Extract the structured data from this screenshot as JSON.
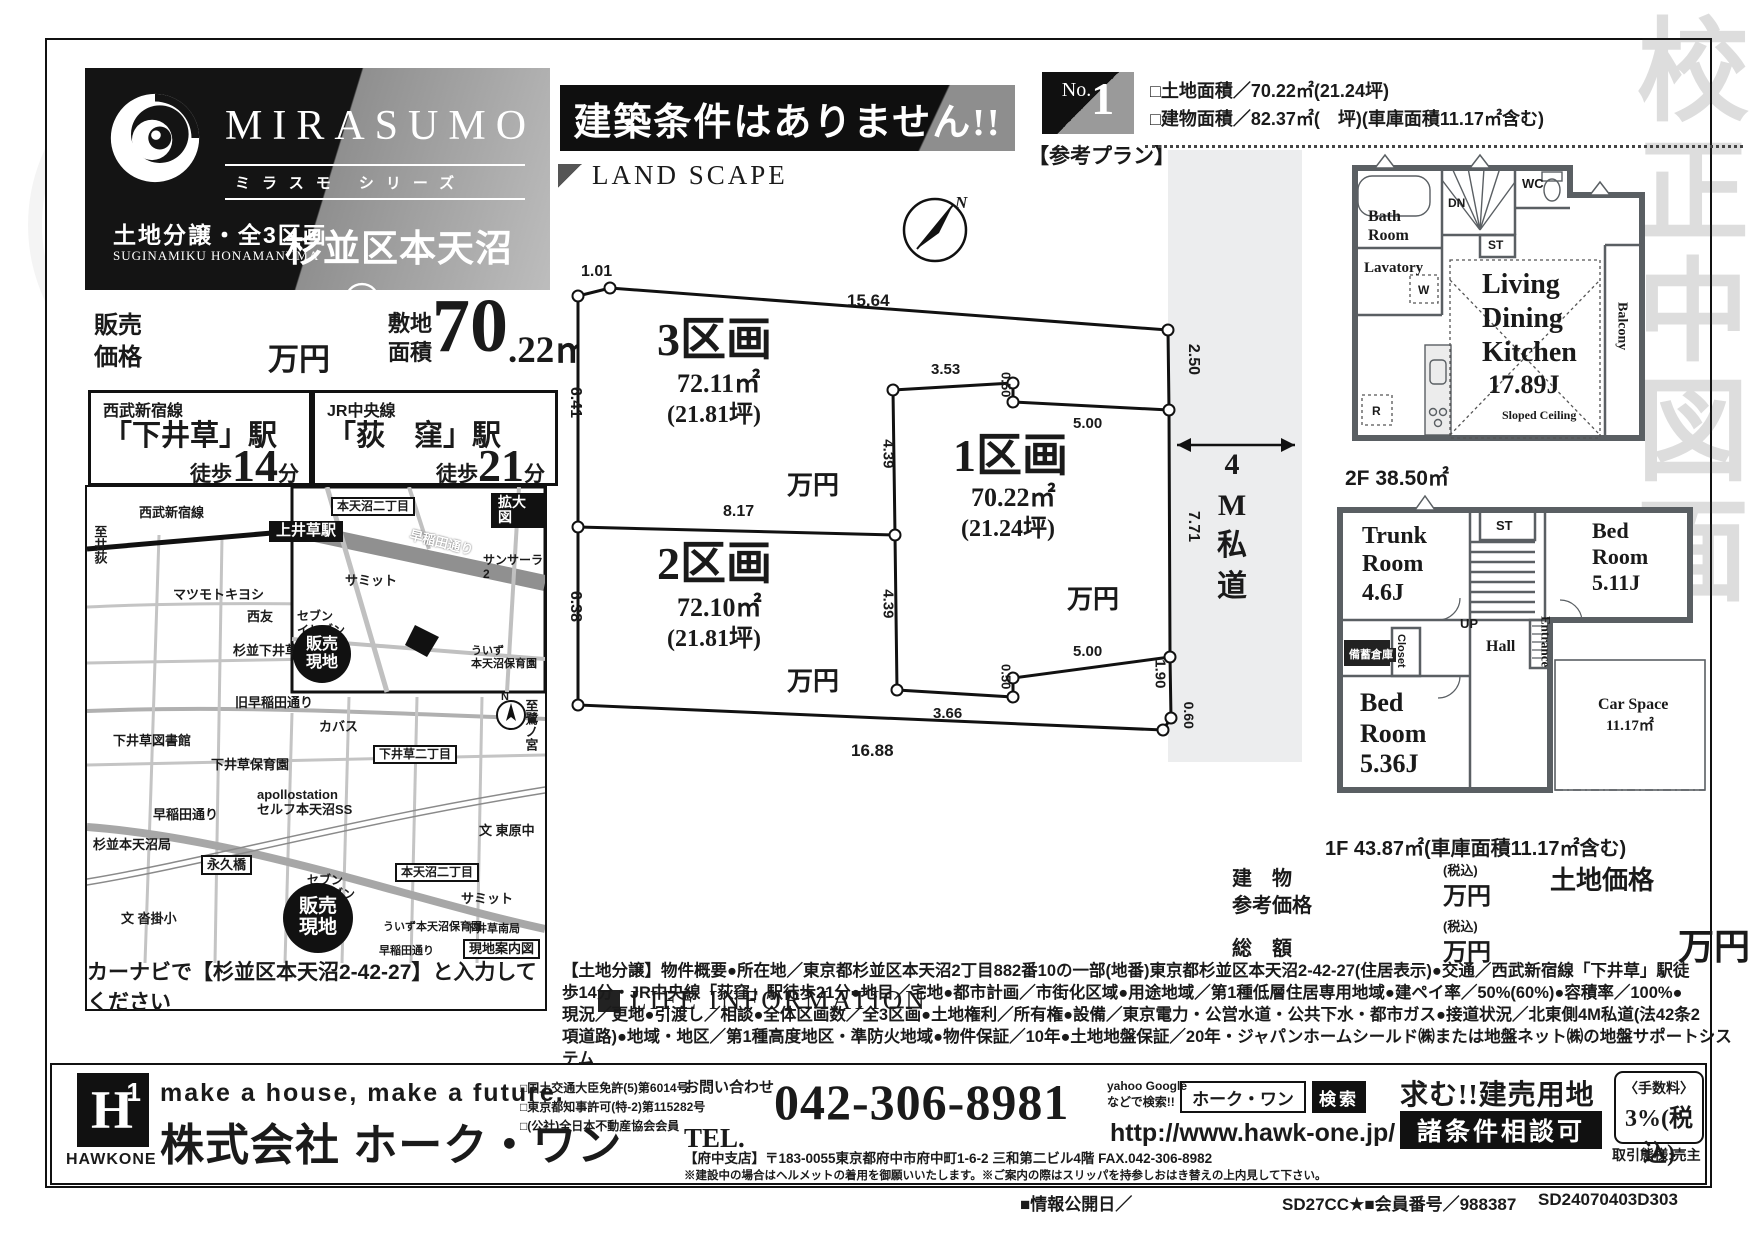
{
  "watermark": "校正中図面",
  "header": {
    "brand_name": "MIRASUMO",
    "brand_series": "ミラスモ シリーズ",
    "brand_category": "土地分譲・全3区画",
    "brand_romaji": "SUGINAMIKU HONAMANUMA",
    "property_name": "杉並区本天沼242③",
    "banner": "建築条件はありません!!",
    "plan_no_prefix": "No.",
    "plan_no": "1",
    "plan_label": "【参考プラン】",
    "land_area_line": "□土地面積／70.22㎡(21.24坪)",
    "building_area_line": "□建物面積／82.37㎡(　坪)(車庫面積11.17㎡含む)"
  },
  "price": {
    "sale_label": "販売\n価格",
    "unit": "万円",
    "site_label": "敷地\n面積",
    "site_big": "70",
    "site_decimal": ".22㎡",
    "site_tsubo": "(21.24坪)",
    "site_suffix": "より"
  },
  "stations": [
    {
      "line": "西武新宿線",
      "name": "「下井草」駅",
      "walk_prefix": "徒歩",
      "walk_num": "14",
      "walk_suffix": "分"
    },
    {
      "line": "JR中央線",
      "name": "「荻　窪」駅",
      "walk_prefix": "徒歩",
      "walk_num": "21",
      "walk_suffix": "分"
    }
  ],
  "map": {
    "caption": "カーナビで【杉並区本天沼2-42-27】と入力してください",
    "compass_n": "N",
    "labels": [
      {
        "t": "至井荻",
        "x": 5,
        "y": 38,
        "fs": 13,
        "cls": "vert"
      },
      {
        "t": "西武新宿線",
        "x": 52,
        "y": 18,
        "fs": 13
      },
      {
        "t": "上井草駅",
        "x": 182,
        "y": 34,
        "fs": 15,
        "cls": "blackbox"
      },
      {
        "t": "至鷺ノ宮",
        "x": 436,
        "y": 212,
        "fs": 13,
        "cls": "vert"
      },
      {
        "t": "マツモトキヨシ",
        "x": 86,
        "y": 100,
        "fs": 13
      },
      {
        "t": "西友",
        "x": 160,
        "y": 122,
        "fs": 13
      },
      {
        "t": "杉並下井草局",
        "x": 146,
        "y": 156,
        "fs": 13
      },
      {
        "t": "旧早稲田通り",
        "x": 148,
        "y": 208,
        "fs": 13
      },
      {
        "t": "下井草図書館",
        "x": 26,
        "y": 246,
        "fs": 13
      },
      {
        "t": "カバス",
        "x": 232,
        "y": 232,
        "fs": 13
      },
      {
        "t": "下井草保育園",
        "x": 124,
        "y": 270,
        "fs": 13
      },
      {
        "t": "下井草二丁目",
        "x": 286,
        "y": 258,
        "fs": 12,
        "cls": "boxed"
      },
      {
        "t": "apollostation\nセルフ本天沼SS",
        "x": 170,
        "y": 300,
        "fs": 13
      },
      {
        "t": "早稲田通り",
        "x": 66,
        "y": 320,
        "fs": 13
      },
      {
        "t": "杉並本天沼局",
        "x": 6,
        "y": 350,
        "fs": 13
      },
      {
        "t": "永久橋",
        "x": 114,
        "y": 368,
        "fs": 13,
        "cls": "boxed"
      },
      {
        "t": "セブン\nイレブン",
        "x": 220,
        "y": 386,
        "fs": 12
      },
      {
        "t": "本天沼二丁目",
        "x": 308,
        "y": 376,
        "fs": 12,
        "cls": "boxed"
      },
      {
        "t": "サミット",
        "x": 374,
        "y": 404,
        "fs": 13
      },
      {
        "t": "ういず本天沼保育園",
        "x": 296,
        "y": 434,
        "fs": 11
      },
      {
        "t": "文 東原中",
        "x": 392,
        "y": 336,
        "fs": 13
      },
      {
        "t": "文 沓掛小",
        "x": 34,
        "y": 424,
        "fs": 13
      },
      {
        "t": "下井草南局",
        "x": 378,
        "y": 436,
        "fs": 11
      },
      {
        "t": "早稲田通り",
        "x": 292,
        "y": 458,
        "fs": 11
      },
      {
        "t": "拡大図",
        "x": 404,
        "y": 6,
        "fs": 14,
        "cls": "blackbox"
      },
      {
        "t": "本天沼二丁目",
        "x": 244,
        "y": 10,
        "fs": 12,
        "cls": "boxed"
      },
      {
        "t": "サミット",
        "x": 258,
        "y": 86,
        "fs": 13
      },
      {
        "t": "サンサーラ2",
        "x": 396,
        "y": 66,
        "fs": 12
      },
      {
        "t": "セブン\nイレブン",
        "x": 210,
        "y": 122,
        "fs": 12
      },
      {
        "t": "ういず\n本天沼保育園",
        "x": 384,
        "y": 158,
        "fs": 11
      },
      {
        "t": "早稲田通り",
        "x": 322,
        "y": 48,
        "fs": 13,
        "rot": 14,
        "cls": "onroad"
      },
      {
        "t": "販売\n現地",
        "x": 196,
        "y": 396,
        "fs": 19,
        "cls": "spot",
        "w": 70,
        "h": 70
      },
      {
        "t": "販売\n現地",
        "x": 206,
        "y": 138,
        "fs": 16,
        "cls": "spot",
        "w": 58,
        "h": 58
      },
      {
        "t": "現地案内図",
        "x": 376,
        "y": 452,
        "fs": 13,
        "cls": "boxed"
      }
    ]
  },
  "landscape": {
    "title": "LAND SCAPE",
    "compass_n": "N",
    "road_text": "4\nM\n私\n道",
    "dims": [
      {
        "t": "1.01",
        "x": 16,
        "y": 118,
        "fs": 16
      },
      {
        "t": "15.64",
        "x": 282,
        "y": 146,
        "fs": 17
      },
      {
        "t": "2.50",
        "x": 612,
        "y": 205,
        "fs": 16,
        "rot": 90
      },
      {
        "t": "7.71",
        "x": 612,
        "y": 372,
        "fs": 16,
        "rot": 90
      },
      {
        "t": "1.90",
        "x": 580,
        "y": 520,
        "fs": 15,
        "rot": 90
      },
      {
        "t": "0.60",
        "x": 610,
        "y": 562,
        "fs": 14,
        "rot": 90
      },
      {
        "t": "16.88",
        "x": 286,
        "y": 596,
        "fs": 17
      },
      {
        "t": "6.41",
        "x": -6,
        "y": 248,
        "fs": 16,
        "rot": 90
      },
      {
        "t": "6.38",
        "x": -6,
        "y": 452,
        "fs": 16,
        "rot": 90
      },
      {
        "t": "8.17",
        "x": 158,
        "y": 358,
        "fs": 16
      },
      {
        "t": "4.39",
        "x": 308,
        "y": 300,
        "fs": 15,
        "rot": 90
      },
      {
        "t": "4.39",
        "x": 308,
        "y": 450,
        "fs": 15,
        "rot": 90
      },
      {
        "t": "3.53",
        "x": 366,
        "y": 216,
        "fs": 15
      },
      {
        "t": "0.50",
        "x": 428,
        "y": 232,
        "fs": 13,
        "rot": 90
      },
      {
        "t": "5.00",
        "x": 508,
        "y": 270,
        "fs": 15
      },
      {
        "t": "3.66",
        "x": 368,
        "y": 560,
        "fs": 15
      },
      {
        "t": "0.50",
        "x": 428,
        "y": 524,
        "fs": 13,
        "rot": 90
      },
      {
        "t": "5.00",
        "x": 508,
        "y": 498,
        "fs": 15
      }
    ],
    "lots": [
      {
        "t": "3区画",
        "x": 92,
        "y": 168,
        "fs": 46,
        "cls": "serif"
      },
      {
        "t": "72.11㎡",
        "x": 112,
        "y": 224,
        "fs": 26,
        "cls": "serif"
      },
      {
        "t": "(21.81坪)",
        "x": 102,
        "y": 256,
        "fs": 24,
        "cls": "serif"
      },
      {
        "t": "万円",
        "x": 222,
        "y": 326,
        "fs": 26,
        "cls": "serif"
      },
      {
        "t": "2区画",
        "x": 92,
        "y": 392,
        "fs": 46,
        "cls": "serif"
      },
      {
        "t": "72.10㎡",
        "x": 112,
        "y": 448,
        "fs": 26,
        "cls": "serif"
      },
      {
        "t": "(21.81坪)",
        "x": 102,
        "y": 480,
        "fs": 24,
        "cls": "serif"
      },
      {
        "t": "万円",
        "x": 222,
        "y": 522,
        "fs": 26,
        "cls": "serif"
      },
      {
        "t": "1区画",
        "x": 388,
        "y": 284,
        "fs": 46,
        "cls": "serif"
      },
      {
        "t": "70.22㎡",
        "x": 406,
        "y": 338,
        "fs": 26,
        "cls": "serif"
      },
      {
        "t": "(21.24坪)",
        "x": 396,
        "y": 370,
        "fs": 24,
        "cls": "serif"
      },
      {
        "t": "万円",
        "x": 502,
        "y": 440,
        "fs": 26,
        "cls": "serif"
      }
    ]
  },
  "life_info": {
    "title": "LIFE INFORMATION"
  },
  "plans": {
    "f2_caption": "2F 38.50㎡",
    "f1_caption": "1F 43.87㎡(車庫面積11.17㎡含む)",
    "f2_labels": [
      {
        "t": "Bath\nRoom",
        "x": 38,
        "y": 58,
        "fs": 16,
        "cls": "serif"
      },
      {
        "t": "DN",
        "x": 118,
        "y": 46,
        "fs": 12
      },
      {
        "t": "ST",
        "x": 158,
        "y": 88,
        "fs": 12
      },
      {
        "t": "WC",
        "x": 192,
        "y": 26,
        "fs": 13
      },
      {
        "t": "Lavatory",
        "x": 34,
        "y": 110,
        "fs": 15,
        "cls": "serif"
      },
      {
        "t": "W",
        "x": 88,
        "y": 133,
        "fs": 12
      },
      {
        "t": "R",
        "x": 42,
        "y": 254,
        "fs": 12
      },
      {
        "t": "Living",
        "x": 152,
        "y": 118,
        "fs": 28,
        "cls": "serif"
      },
      {
        "t": "Dining",
        "x": 152,
        "y": 152,
        "fs": 28,
        "cls": "serif"
      },
      {
        "t": "Kitchen",
        "x": 152,
        "y": 186,
        "fs": 28,
        "cls": "serif"
      },
      {
        "t": "17.89J",
        "x": 158,
        "y": 220,
        "fs": 26,
        "cls": "serif"
      },
      {
        "t": "Sloped Ceiling",
        "x": 172,
        "y": 258,
        "fs": 12,
        "cls": "serif"
      },
      {
        "t": "Balcony",
        "x": 283,
        "y": 152,
        "fs": 14,
        "cls": "vert serif"
      }
    ],
    "f1_labels": [
      {
        "t": "Trunk\nRoom\n4.6J",
        "x": 42,
        "y": 32,
        "fs": 24,
        "cls": "serif"
      },
      {
        "t": "ST",
        "x": 176,
        "y": 28,
        "fs": 13
      },
      {
        "t": "Bed\nRoom\n5.11J",
        "x": 272,
        "y": 28,
        "fs": 22,
        "cls": "serif"
      },
      {
        "t": "UP",
        "x": 140,
        "y": 126,
        "fs": 13
      },
      {
        "t": "Hall",
        "x": 166,
        "y": 148,
        "fs": 16,
        "cls": "serif"
      },
      {
        "t": "Entrance",
        "x": 218,
        "y": 126,
        "fs": 13,
        "cls": "vert serif"
      },
      {
        "t": "Closet",
        "x": 74,
        "y": 144,
        "fs": 11,
        "cls": "vert"
      },
      {
        "t": "備蓄倉庫",
        "x": 26,
        "y": 158,
        "fs": 11,
        "cls": "darkbox"
      },
      {
        "t": "Bed\nRoom\n5.36J",
        "x": 40,
        "y": 198,
        "fs": 26,
        "cls": "serif"
      },
      {
        "t": "Car Space",
        "x": 278,
        "y": 206,
        "fs": 16,
        "cls": "serif"
      },
      {
        "t": "11.17㎡",
        "x": 286,
        "y": 228,
        "fs": 15,
        "cls": "serif"
      }
    ]
  },
  "pricing": {
    "building_label": "建　物\n参考価格",
    "tax_note1": "(税込)",
    "unit1": "万円",
    "land_label": "土地価格",
    "total_label": "総　額",
    "tax_note2": "(税込)",
    "unit2": "万円",
    "big_unit": "万円"
  },
  "description": {
    "lines": [
      "【土地分譲】物件概要●所在地／東京都杉並区本天沼2丁目882番10の一部(地番)東京都杉並区本天沼2-42-27(住居表示)●交通／西武新宿線「下井草」駅徒",
      "歩14分・JR中央線「荻窪」駅徒歩21分●地目／宅地●都市計画／市街化区域●用途地域／第1種低層住居専用地域●建ペイ率／50%(60%)●容積率／100%●",
      "現況／更地●引渡し／相談●全体区画数／全3区画●土地権利／所有権●設備／東京電力・公営水道・公共下水・都市ガス●接道状況／北東側4M私道(法42条2",
      "項道路)●地域・地区／第1種高度地区・準防火地域●物件保証／10年●土地地盤保証／20年・ジャパンホームシールド㈱または地盤ネット㈱の地盤サポートシステム",
      "※図面と現況が異なる場合は現況を優先とさせていただきます。"
    ]
  },
  "footer": {
    "logo_h": "H",
    "logo_one": "1",
    "logo_name": "HAWKONE",
    "tagline": "make a house, make a future.",
    "company": "株式会社 ホーク・ワン",
    "licenses": [
      "□国土交通大臣免許(5)第6014号",
      "□東京都知事許可(特-2)第115282号",
      "□(公社)全日本不動産協会会員"
    ],
    "contact_label": "お問い合わせ",
    "tel_prefix": "TEL.",
    "tel_number": "042-306-8981",
    "address": "【府中支店】〒183-0055東京都府中市府中町1-6-2 三和第二ビル4階 FAX.042-306-8982",
    "note": "※建設中の場合はヘルメットの着用を御願いいたします。※ご案内の際はスリッパを持参しおはき替えの上内見して下さい。",
    "search_hint": "yahoo Google\nなどで検索!!",
    "search_box": "ホーク・ワン",
    "search_button": "検索",
    "url": "http://www.hawk-one.jp/",
    "seek": "求む!!建売用地",
    "consult": "諸条件相談可",
    "fee_label": "〈手数料〉",
    "fee_value": "3%(税込)",
    "deal_type": "取引態様:売主",
    "code_left": "■情報公開日／",
    "code_mid": "SD27CC★■会員番号／988387",
    "code_right": "SD24070403D303"
  }
}
